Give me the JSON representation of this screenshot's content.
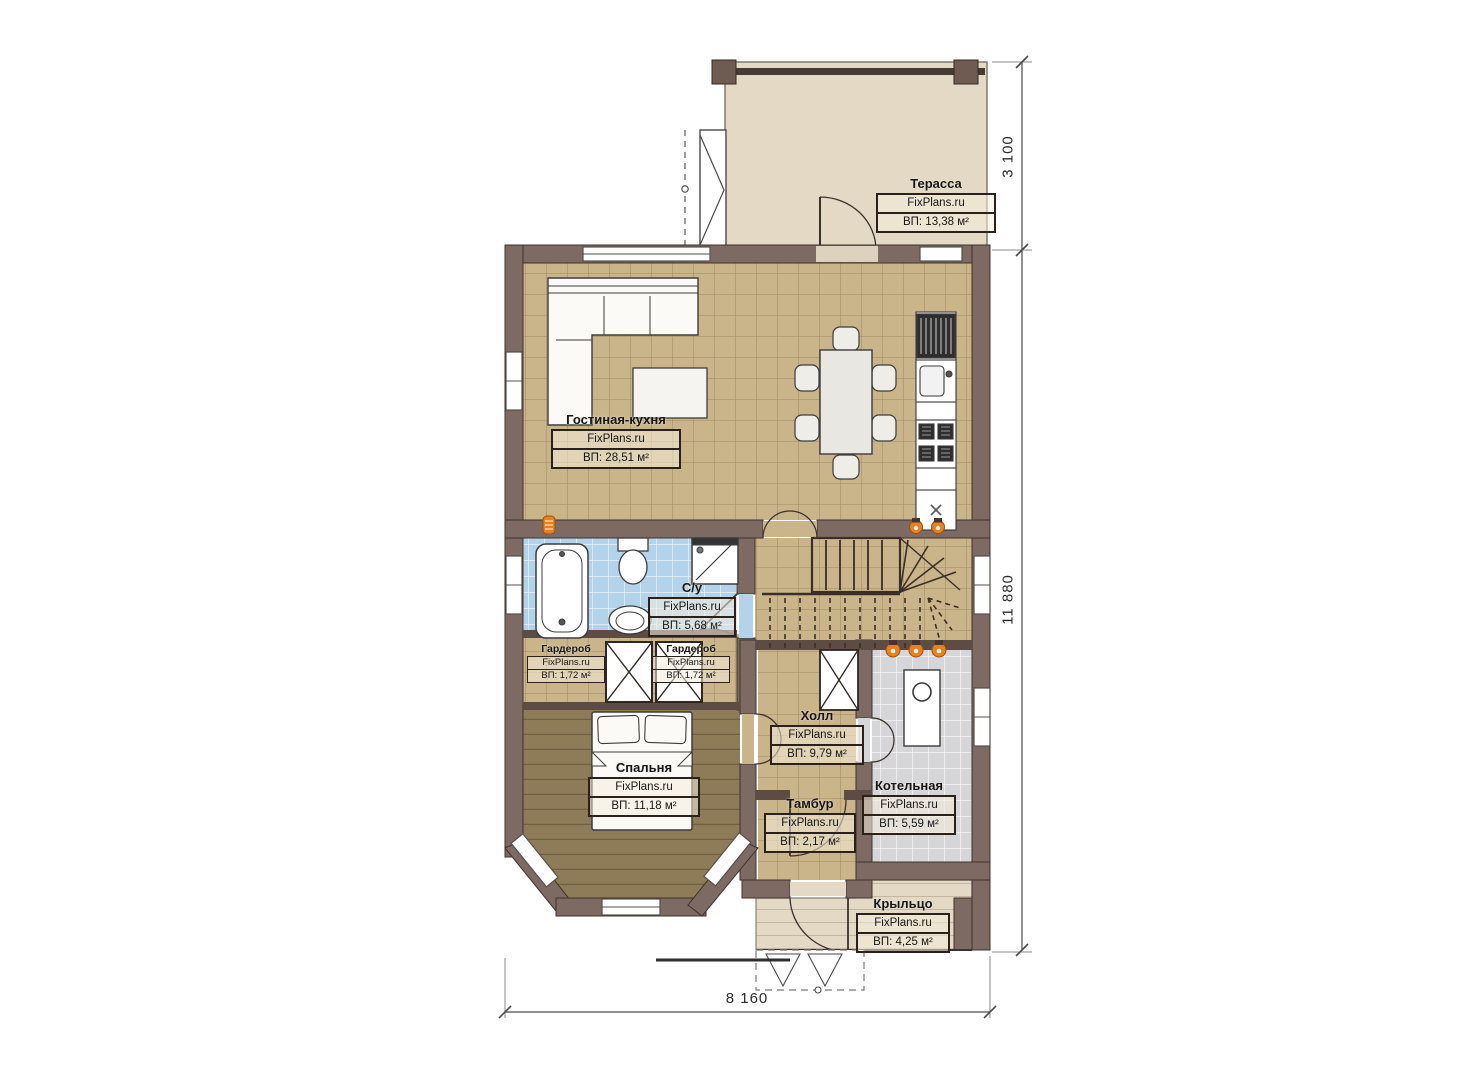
{
  "rooms": [
    {
      "id": "terrace",
      "name": "Терасса",
      "brand": "FixPlans.ru",
      "area": "ВП: 13,38 м²"
    },
    {
      "id": "living-kitchen",
      "name": "Гостиная-кухня",
      "brand": "FixPlans.ru",
      "area": "ВП: 28,51 м²"
    },
    {
      "id": "bathroom",
      "name": "С/у",
      "brand": "FixPlans.ru",
      "area": "ВП: 5,68 м²"
    },
    {
      "id": "wardrobe-left",
      "name": "Гардероб",
      "brand": "FixPlans.ru",
      "area": "ВП: 1,72 м²"
    },
    {
      "id": "wardrobe-right",
      "name": "Гардероб",
      "brand": "FixPlans.ru",
      "area": "ВП: 1,72 м²"
    },
    {
      "id": "bedroom",
      "name": "Спальня",
      "brand": "FixPlans.ru",
      "area": "ВП: 11,18 м²"
    },
    {
      "id": "hall",
      "name": "Холл",
      "brand": "FixPlans.ru",
      "area": "ВП: 9,79 м²"
    },
    {
      "id": "vestibule",
      "name": "Тамбур",
      "brand": "FixPlans.ru",
      "area": "ВП: 2,17 м²"
    },
    {
      "id": "boiler-room",
      "name": "Котельная",
      "brand": "FixPlans.ru",
      "area": "ВП: 5,59 м²"
    },
    {
      "id": "porch",
      "name": "Крыльцо",
      "brand": "FixPlans.ru",
      "area": "ВП: 4,25 м²"
    }
  ],
  "dimensions": {
    "terrace_depth": "3 100",
    "house_length": "11 880",
    "house_width": "8 160"
  },
  "colors": {
    "wall": "#7d6a63",
    "wall_outline": "#3f332c",
    "thin_wall": "#5c4c44",
    "living_floor": "#cab58a",
    "bedroom_floor": "#8e7b57",
    "bath_floor": "#b3d3ea",
    "boiler_floor": "#d6d6d8",
    "terrace_floor": "#e4d9c5",
    "flame_accent": "#e8801e"
  }
}
